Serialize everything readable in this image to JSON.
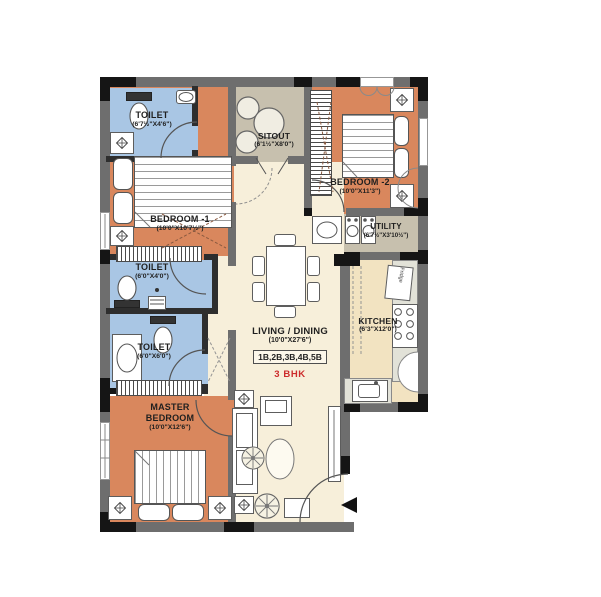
{
  "rooms": {
    "toilet1": {
      "name": "TOILET",
      "dims": "(6'7½\"X4'6\")"
    },
    "bedroom1": {
      "name": "BEDROOM -1",
      "dims": "(10'0\"X10'7½\")"
    },
    "sitout": {
      "name": "SITOUT",
      "dims": "(6'1½\"X8'0\")"
    },
    "bedroom2": {
      "name": "BEDROOM -2",
      "dims": "(10'0\"X11'3\")"
    },
    "utility": {
      "name": "UTILITY",
      "dims": "(6'7½\"X3'10½\")"
    },
    "toilet2": {
      "name": "TOILET",
      "dims": "(6'0\"X4'0\")"
    },
    "toilet3": {
      "name": "TOILET",
      "dims": "(6'0\"X6'0\")"
    },
    "living": {
      "name": "LIVING / DINING",
      "dims": "(10'0\"X27'6\")"
    },
    "kitchen": {
      "name": "KITCHEN",
      "dims": "(6'3\"X12'0\")"
    },
    "master": {
      "name": "MASTER BEDROOM",
      "dims": "(10'0\"X12'6\")"
    }
  },
  "unit": {
    "variants": "1B,2B,3B,4B,5B",
    "type": "3 BHK"
  },
  "appliances": {
    "fridge_label": "Fridge"
  },
  "colors": {
    "bedroom": "#d9875d",
    "toilet": "#a9c6e4",
    "living": "#f7efda",
    "kitchen": "#f2e3c1",
    "sitout_utility": "#c7c0ae",
    "wall": "#6e6e6e",
    "accent_red": "#cc2b2b"
  }
}
